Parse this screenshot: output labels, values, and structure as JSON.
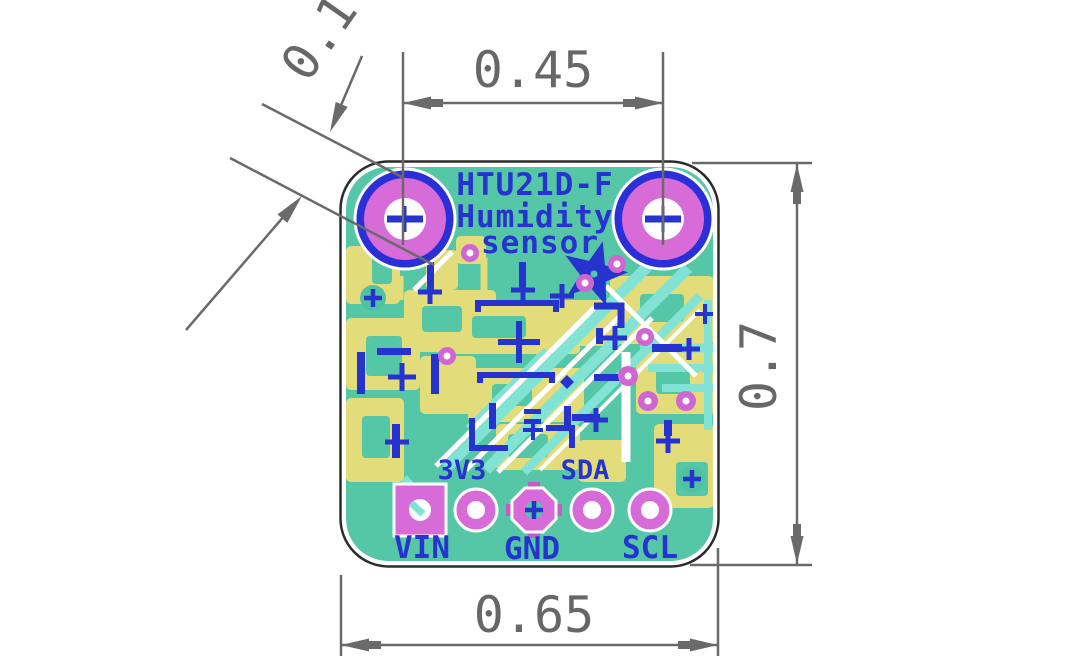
{
  "drawing": {
    "type": "pcb-dimensioned-technical-drawing",
    "dimensions": {
      "hole_diameter": {
        "label": "0.1"
      },
      "hole_pitch": {
        "label": "0.45"
      },
      "board_height": {
        "label": "0.7"
      },
      "board_width": {
        "label": "0.65"
      }
    },
    "board": {
      "silkscreen_title": {
        "line1": "HTU21D-F",
        "line2": "Humidity",
        "line3": "sensor"
      },
      "pins": {
        "vin": {
          "label": "VIN",
          "pad_shape": "square"
        },
        "v33": {
          "label": "3V3",
          "pad_shape": "round"
        },
        "gnd": {
          "label": "GND",
          "pad_shape": "octagon"
        },
        "sda": {
          "label": "SDA",
          "pad_shape": "round"
        },
        "scl": {
          "label": "SCL",
          "pad_shape": "round"
        }
      },
      "icons": {
        "logo": "flower-logo-icon",
        "mounting_holes": "mounting-hole-icon"
      },
      "colors": {
        "soldermask_teal": "#55c7a6",
        "copper_yellow": "#e2dc7b",
        "silkscreen_blue": "#2633cf",
        "pad_magenta": "#d76bd8",
        "via_magenta": "#cf66d2",
        "trace_cyan": "#82e3d5",
        "trace_white": "#ffffff",
        "dimension_gray": "#6a6a6a",
        "board_outline": "#2b2b2b"
      }
    }
  }
}
